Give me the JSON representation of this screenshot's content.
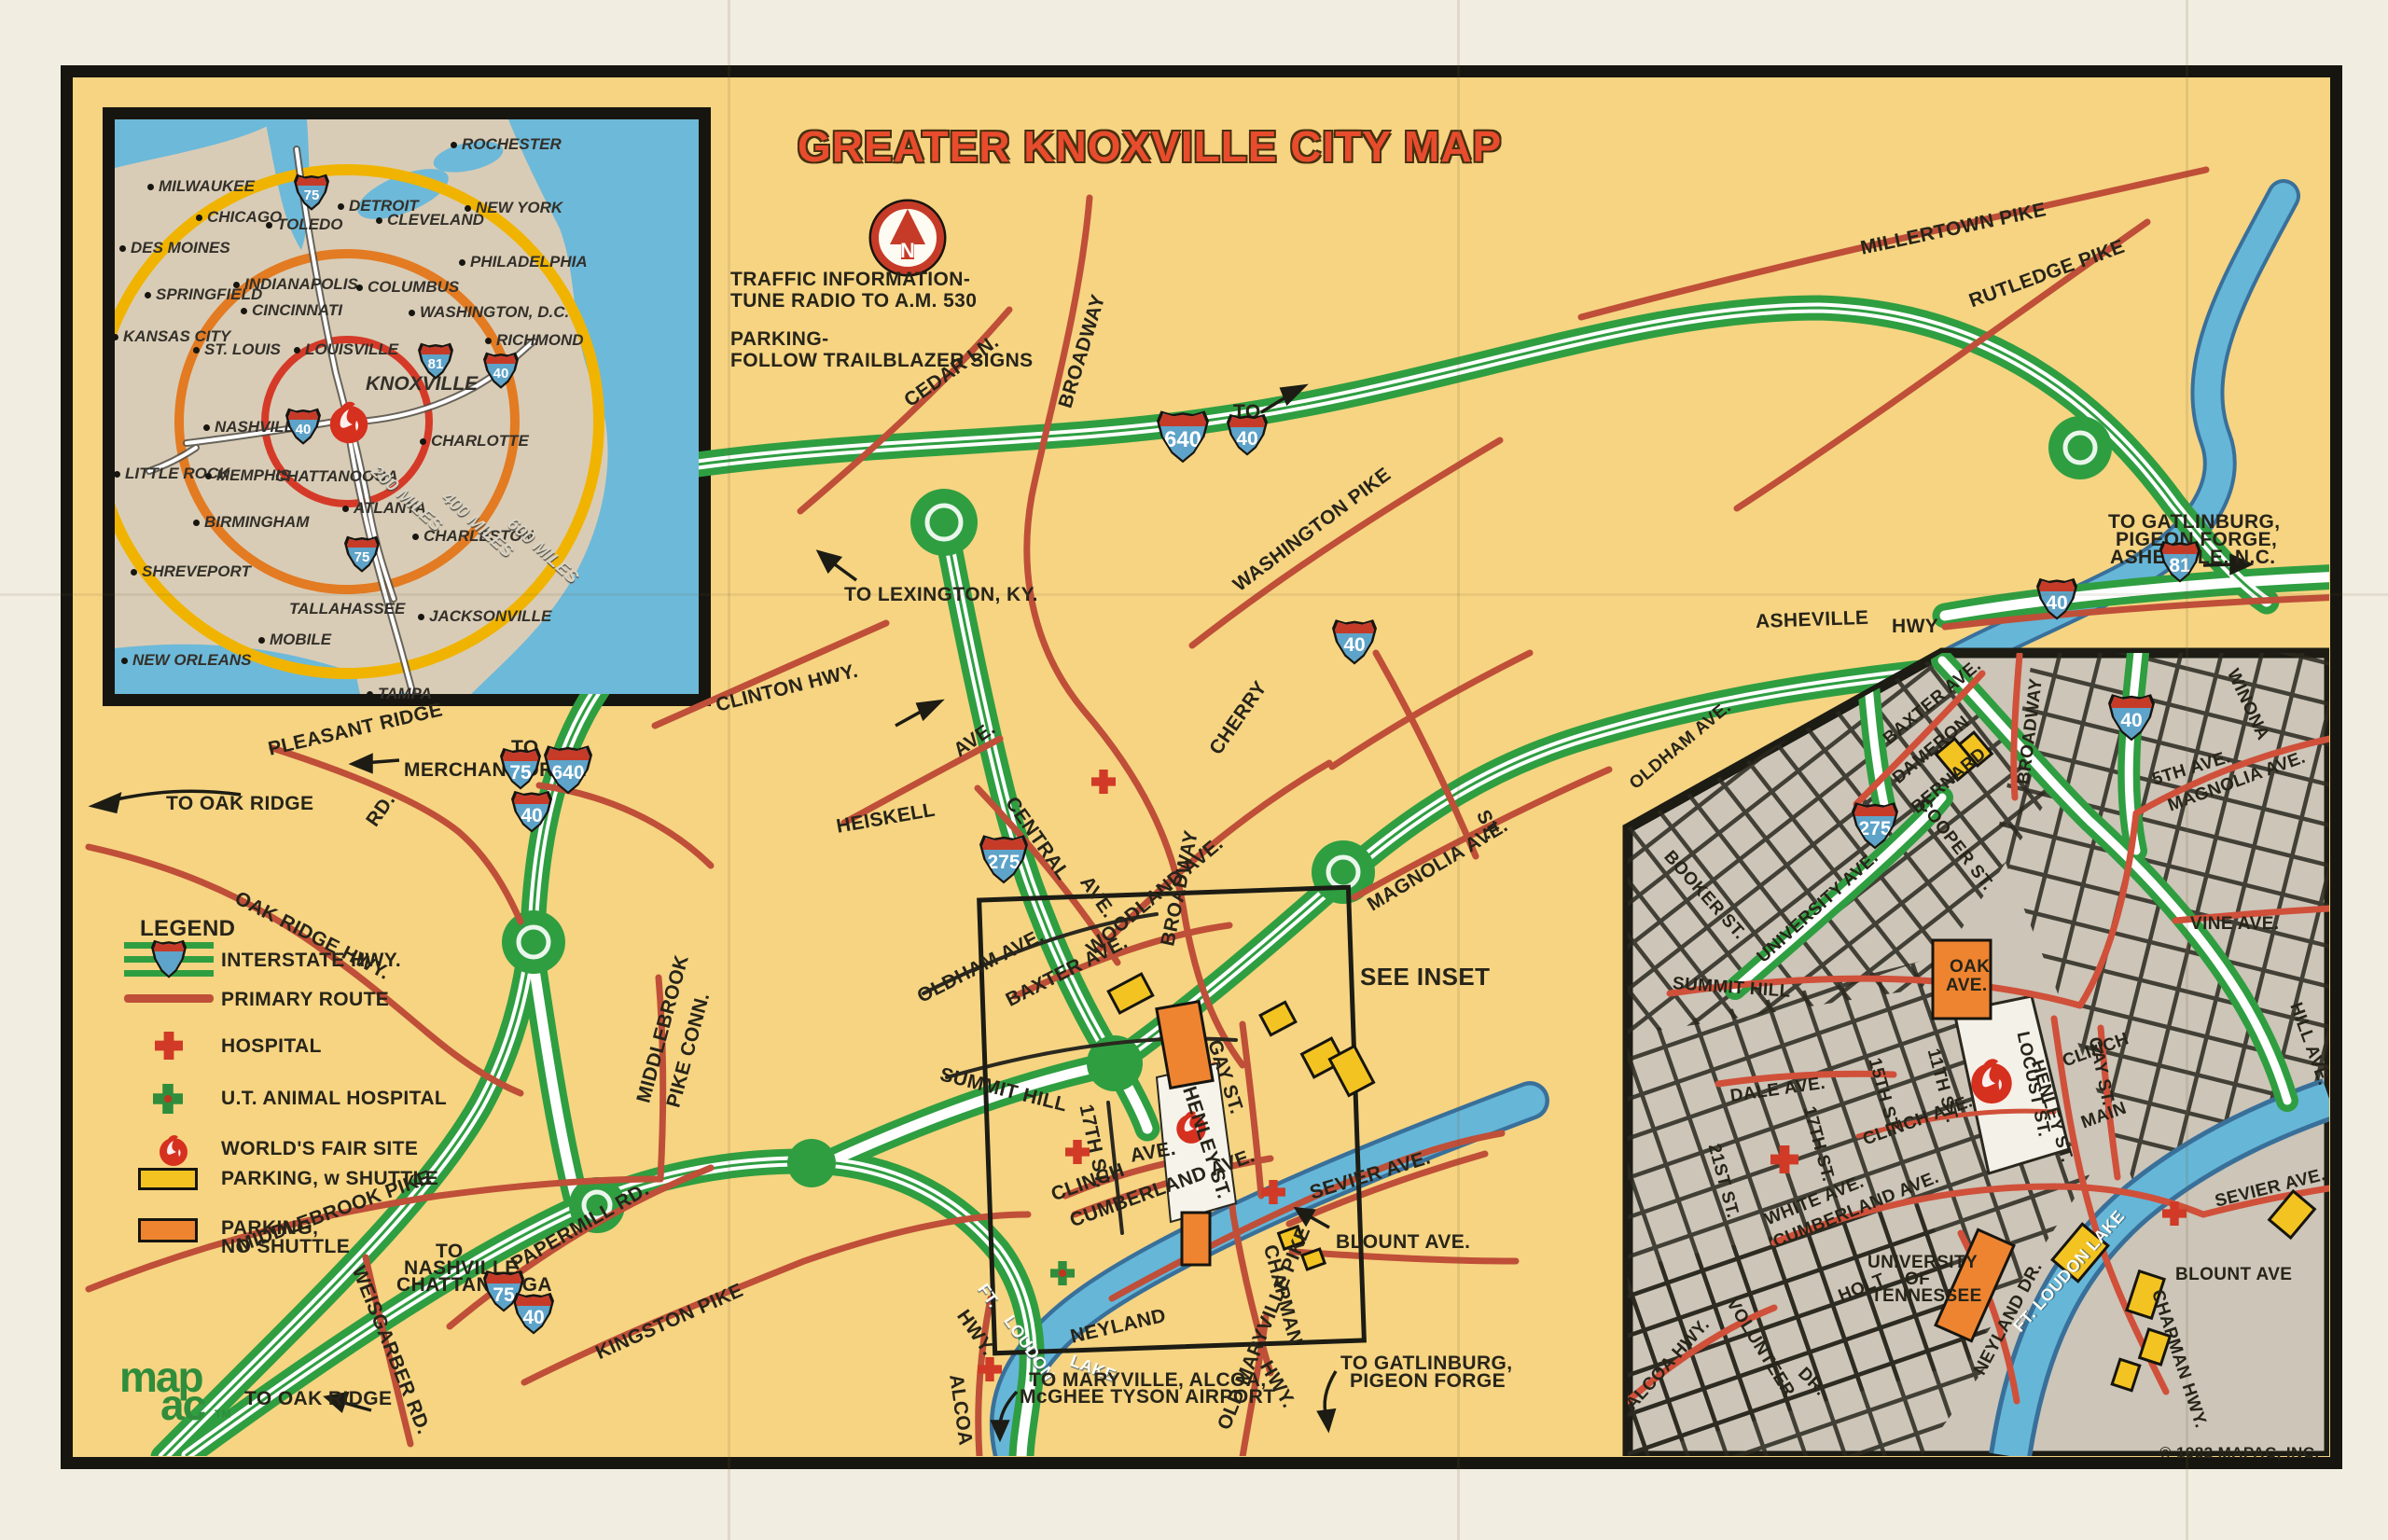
{
  "title": "GREATER KNOXVILLE CITY MAP",
  "notes": {
    "traffic_line1": "TRAFFIC INFORMATION-",
    "traffic_line2": "TUNE RADIO TO A.M. 530",
    "parking_line1": "PARKING-",
    "parking_line2": "FOLLOW TRAILBLAZER SIGNS"
  },
  "regional_inset": {
    "cities": {
      "milwaukee": "MILWAUKEE",
      "chicago": "CHICAGO",
      "des_moines": "DES MOINES",
      "springfield": "SPRINGFIELD",
      "kansas_city": "KANSAS CITY",
      "st_louis": "ST. LOUIS",
      "toledo": "TOLEDO",
      "detroit": "DETROIT",
      "cleveland": "CLEVELAND",
      "rochester": "ROCHESTER",
      "new_york": "NEW YORK",
      "philadelphia": "PHILADELPHIA",
      "indianapolis": "INDIANAPOLIS",
      "columbus": "COLUMBUS",
      "cincinnati": "CINCINNATI",
      "washington_dc": "WASHINGTON, D.C.",
      "richmond": "RICHMOND",
      "louisville": "LOUISVILLE",
      "knoxville": "KNOXVILLE",
      "nashville": "NASHVILLE",
      "charlotte": "CHARLOTTE",
      "little_rock": "LITTLE ROCK",
      "memphis": "MEMPHIS",
      "chattanooga": "CHATTANOOGA",
      "atlanta": "ATLANTA",
      "birmingham": "BIRMINGHAM",
      "charleston": "CHARLESTON",
      "shreveport": "SHREVEPORT",
      "tallahassee": "TALLAHASSEE",
      "jacksonville": "JACKSONVILLE",
      "mobile": "MOBILE",
      "new_orleans": "NEW ORLEANS",
      "tampa": "TAMPA"
    },
    "rings": {
      "r200": "200 MILES",
      "r400": "400 MILES",
      "r600": "600 MILES"
    },
    "shields": {
      "i75": "75",
      "i81": "81",
      "i40": "40"
    }
  },
  "legend": {
    "heading": "LEGEND",
    "items": [
      {
        "label": "INTERSTATE HWY.",
        "symbol": "interstate-shield"
      },
      {
        "label": "PRIMARY ROUTE",
        "symbol": "red-line"
      },
      {
        "label": "HOSPITAL",
        "symbol": "red-cross"
      },
      {
        "label": "U.T. ANIMAL HOSPITAL",
        "symbol": "green-cross"
      },
      {
        "label": "WORLD'S FAIR SITE",
        "symbol": "flame"
      },
      {
        "label": "PARKING, w SHUTTLE",
        "symbol": "yellow-box"
      },
      {
        "label": "PARKING,",
        "label2": "NO SHUTTLE",
        "symbol": "orange-box"
      }
    ]
  },
  "main_map": {
    "shields": {
      "i640": "640",
      "i75": "75",
      "i40": "40",
      "i275": "275",
      "i81": "81",
      "to": "TO"
    },
    "labels": {
      "cedar_ln": "CEDAR LN.",
      "broadway_north": "BROADWAY",
      "millertown": "MILLERTOWN PIKE",
      "rutledge": "RUTLEDGE PIKE",
      "washington_pike": "WASHINGTON PIKE",
      "asheville": "ASHEVILLE",
      "asheville_hwy": "HWY",
      "cherry": "CHERRY",
      "cherry_st": "ST.",
      "to_lexington": "TO LEXINGTON, KY.",
      "clinton_hwy": "CLINTON HWY.",
      "pleasant_ridge": "PLEASANT RIDGE",
      "pleasant_ridge_rd": "RD.",
      "to_oak_ridge_north": "TO OAK RIDGE",
      "merchant_drive": "MERCHANT DRIVE",
      "oak_ridge_hwy": "OAK RIDGE HWY.",
      "heiskell": "HEISKELL",
      "heiskell_ave": "AVE.",
      "central": "CENTRAL",
      "central_ave": "AVE.",
      "woodland_ave": "WOODLAND AVE.",
      "broadway_central": "BROADWAY",
      "oldham_ave": "OLDHAM AVE.",
      "baxter_ave": "BAXTER AVE.",
      "summit_hill": "SUMMIT HILL",
      "see_inset": "SEE INSET",
      "magnolia_ave": "MAGNOLIA AVE.",
      "gay_st": "GAY ST.",
      "henley_st": "HENLEY ST.",
      "seventeenth_st": "17TH ST.",
      "clinch": "CLINCH",
      "clinch_ave": "AVE.",
      "cumberland_ave": "CUMBERLAND AVE.",
      "sevier_ave": "SEVIER AVE.",
      "blount_ave": "BLOUNT AVE.",
      "chapman": "CHAPMAN",
      "chapman_hwy": "HWY.",
      "neyland": "NEYLAND",
      "ft_loudon_ft": "FT.",
      "ft_loudon_loudon": "LOUDON",
      "ft_loudon_lake": "LAKE",
      "alcoa": "ALCOA",
      "alcoa_hwy": "HWY.",
      "to_maryville_line1": "TO MARYVILLE, ALCOA,",
      "to_maryville_line2": "McGHEE TYSON AIRPORT",
      "old_maryville_pike": "OLD MARYVILLE PIKE",
      "to_gatlinburg_line1": "TO GATLINBURG,",
      "to_gatlinburg_line2": "PIGEON FORGE",
      "kingston_pike": "KINGSTON PIKE",
      "papermill_rd": "PAPERMILL RD.",
      "to_nashville_line1": "TO",
      "to_nashville_line2": "NASHVILLE,",
      "to_nashville_line3": "CHATTANOOGA",
      "weisgarber_rd": "WEISGARBER RD.",
      "middlebrook_pike": "MIDDLEBROOK PIKE",
      "middlebrook": "MIDDLEBROOK",
      "pike_conn": "PIKE CONN.",
      "to_oak_ridge_south": "TO OAK RIDGE",
      "to_gatlinburg_ashe_line1": "TO GATLINBURG,",
      "to_gatlinburg_ashe_line2": "PIGEON FORGE,",
      "to_gatlinburg_ashe_line3": "ASHEVILLE, N.C."
    }
  },
  "downtown_inset": {
    "shields": {
      "i275": "275",
      "i40": "40"
    },
    "labels": {
      "oldham_ave": "OLDHAM AVE.",
      "baxter_ave": "BAXTER AVE.",
      "dameron": "DAMERON",
      "bernard": "BERNARD",
      "cooper_st": "COOPER ST.",
      "broadway": "BROADWAY",
      "booker_st": "BOOKER ST.",
      "university_ave": "UNIVERSITY AVE.",
      "fifth_ave": "5TH AVE.",
      "magnolia_ave": "MAGNOLIA AVE.",
      "winona": "WINONA",
      "vine_ave": "VINE AVE.",
      "summit_hill": "SUMMIT HILL",
      "oak": "OAK",
      "oak_ave": "AVE.",
      "dale_ave": "DALE AVE.",
      "st21": "21ST ST.",
      "st17": "17TH ST.",
      "st15": "15TH ST.",
      "st11": "11TH ST.",
      "clinch_ave": "CLINCH AVE.",
      "white_ave": "WHITE AVE.",
      "cumberland_ave": "CUMBERLAND AVE.",
      "locust_st": "LOCUST ST.",
      "henley_st": "HENLEY ST.",
      "clinch": "CLINCH",
      "main": "MAIN",
      "gay_st": "GAY ST.",
      "hill_ave": "HILL AVE.",
      "sevier_ave": "SEVIER AVE.",
      "blount_ave": "BLOUNT AVE",
      "chapman_hwy": "CHAPMAN HWY.",
      "volunteer": "VOLUNTEER",
      "volunteer_dr": "DR.",
      "holt": "HOLT",
      "university_line1": "UNIVERSITY",
      "university_line2": "OF",
      "university_line3": "TENNESSEE",
      "neyland_dr": "NEYLAND DR.",
      "ft_loudon_lake": "FT. LOUDON LAKE",
      "alcoa_hwy": "ALCOA HWY."
    }
  },
  "footer": {
    "logo_text": "map",
    "logo_text2": "ac",
    "trademark": "TM",
    "copyright": "© 1982 MAPAC, INC."
  },
  "colors": {
    "accent_red": "#e84c2d",
    "map_bg": "#f6d482",
    "freeway_green": "#2f9e41",
    "route_red": "#bf4f38",
    "water_blue": "#66b6d8",
    "inset_land": "#d9ccb6",
    "ring_yellow": "#f0b400",
    "ring_orange": "#e37b22",
    "ring_red": "#d53a28",
    "parking_yellow": "#f3c421",
    "parking_orange": "#ee8430",
    "inset_gray": "#ccc5b8"
  }
}
